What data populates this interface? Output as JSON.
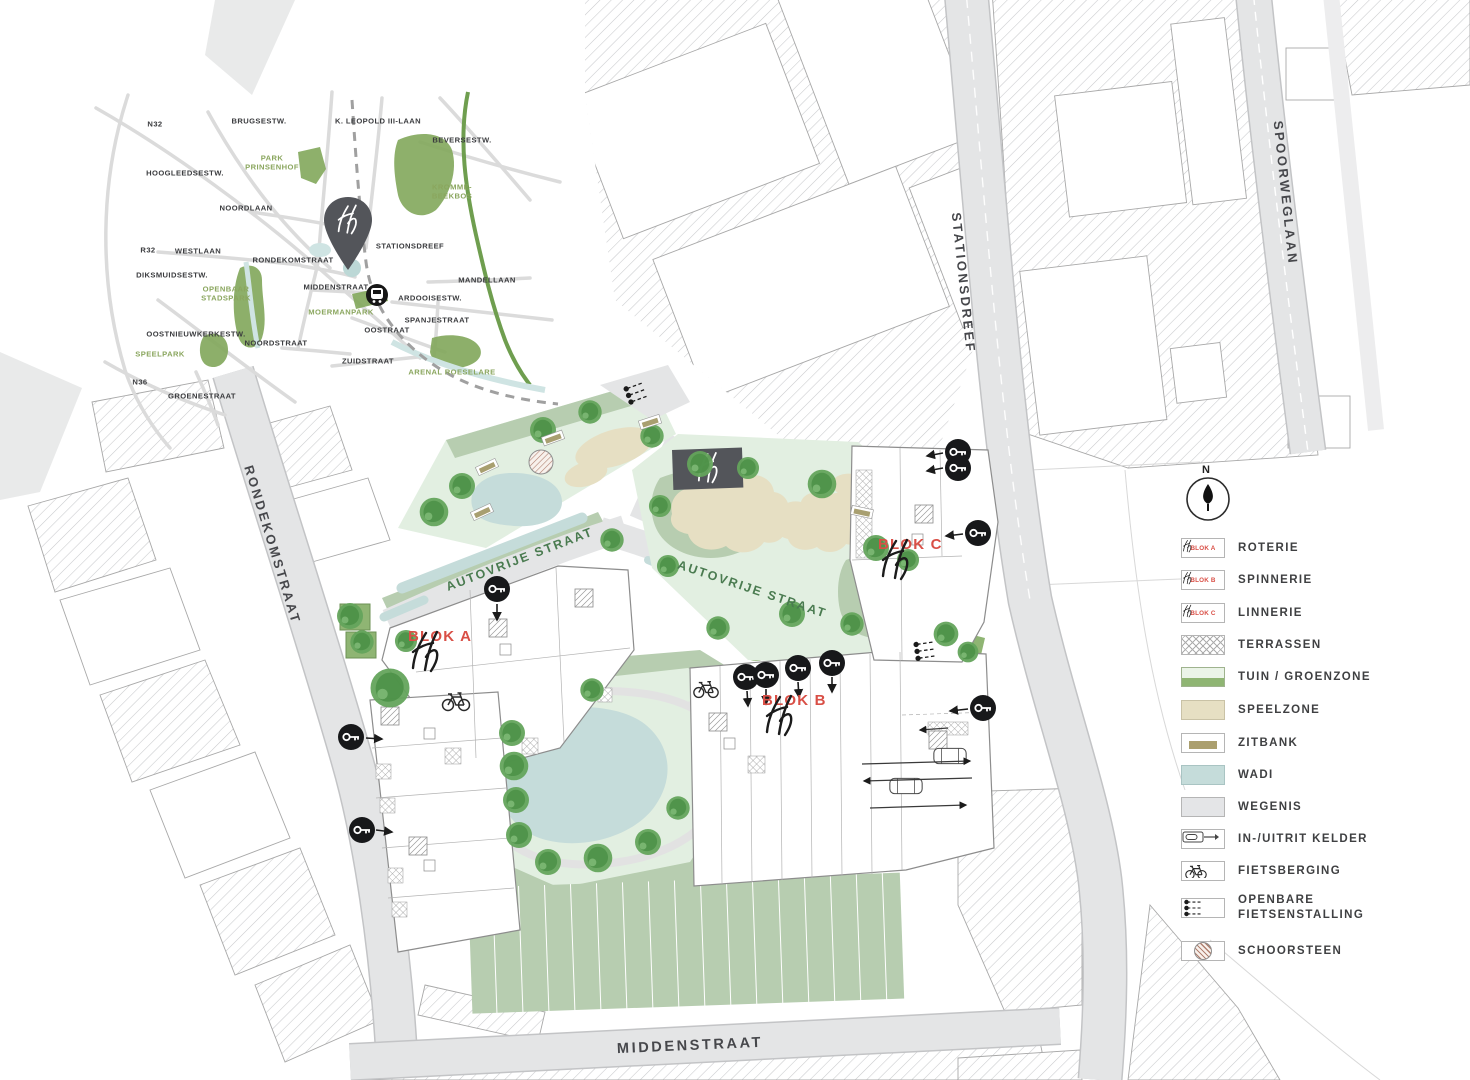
{
  "inset": {
    "labels": [
      "N32",
      "BRUGSESTW.",
      "K. LEOPOLD III-LAAN",
      "BEVERSESTW.",
      "HOOGLEEDSESTW.",
      "PARK\nPRINSENHOF",
      "KROMME-\nBEEKBOS",
      "NOORDLAAN",
      "R32",
      "WESTLAAN",
      "RONDEKOMSTRAAT",
      "STATIONSDREEF",
      "DIKSMUIDSESTW.",
      "MANDELLAAN",
      "OPENBAAR\nSTADSPARK",
      "MIDDENSTRAAT",
      "ARDOOISESTW.",
      "MOERMANPARK",
      "SPANJESTRAAT",
      "OOSTNIEUWKERKESTW.",
      "OOSTRAAT",
      "NOORDSTRAAT",
      "SPEELPARK",
      "ZUIDSTRAAT",
      "N36",
      "GROENESTRAAT",
      "ARENAL ROESELARE"
    ]
  },
  "plan": {
    "street_labels": [
      "RONDEKOMSTRAAT",
      "STATIONSDREEF",
      "SPOORWEGLAAN",
      "MIDDENSTRAAT",
      "AUTOVRIJE STRAAT",
      "AUTOVRIJE STRAAT"
    ],
    "block_labels": [
      "BLOK A",
      "BLOK B",
      "BLOK C"
    ]
  },
  "legend": {
    "compass": "N",
    "items": [
      {
        "label": "ROTERIE",
        "swatch": "BLOK A"
      },
      {
        "label": "SPINNERIE",
        "swatch": "BLOK B"
      },
      {
        "label": "LINNERIE",
        "swatch": "BLOK C"
      },
      {
        "label": "TERRASSEN"
      },
      {
        "label": "TUIN / GROENZONE"
      },
      {
        "label": "SPEELZONE"
      },
      {
        "label": "ZITBANK"
      },
      {
        "label": "WADI"
      },
      {
        "label": "WEGENIS"
      },
      {
        "label": "IN-/UITRIT KELDER"
      },
      {
        "label": "FIETSBERGING"
      },
      {
        "label": "OPENBARE\nFIETSENSTALLING"
      },
      {
        "label": "SCHOORSTEEN"
      }
    ]
  },
  "colors": {
    "accent_red": "#d94f46",
    "green_zone": "#8fb573",
    "green_band": "#b7cdb0",
    "green_light": "#e2efe1",
    "wadi": "#c5dcda",
    "speelzone": "#e6dfc3",
    "wegenis": "#e4e5e6",
    "zitbank": "#ab9f6e",
    "street_green": "#4a7b50",
    "pin_gray": "#53555a"
  }
}
